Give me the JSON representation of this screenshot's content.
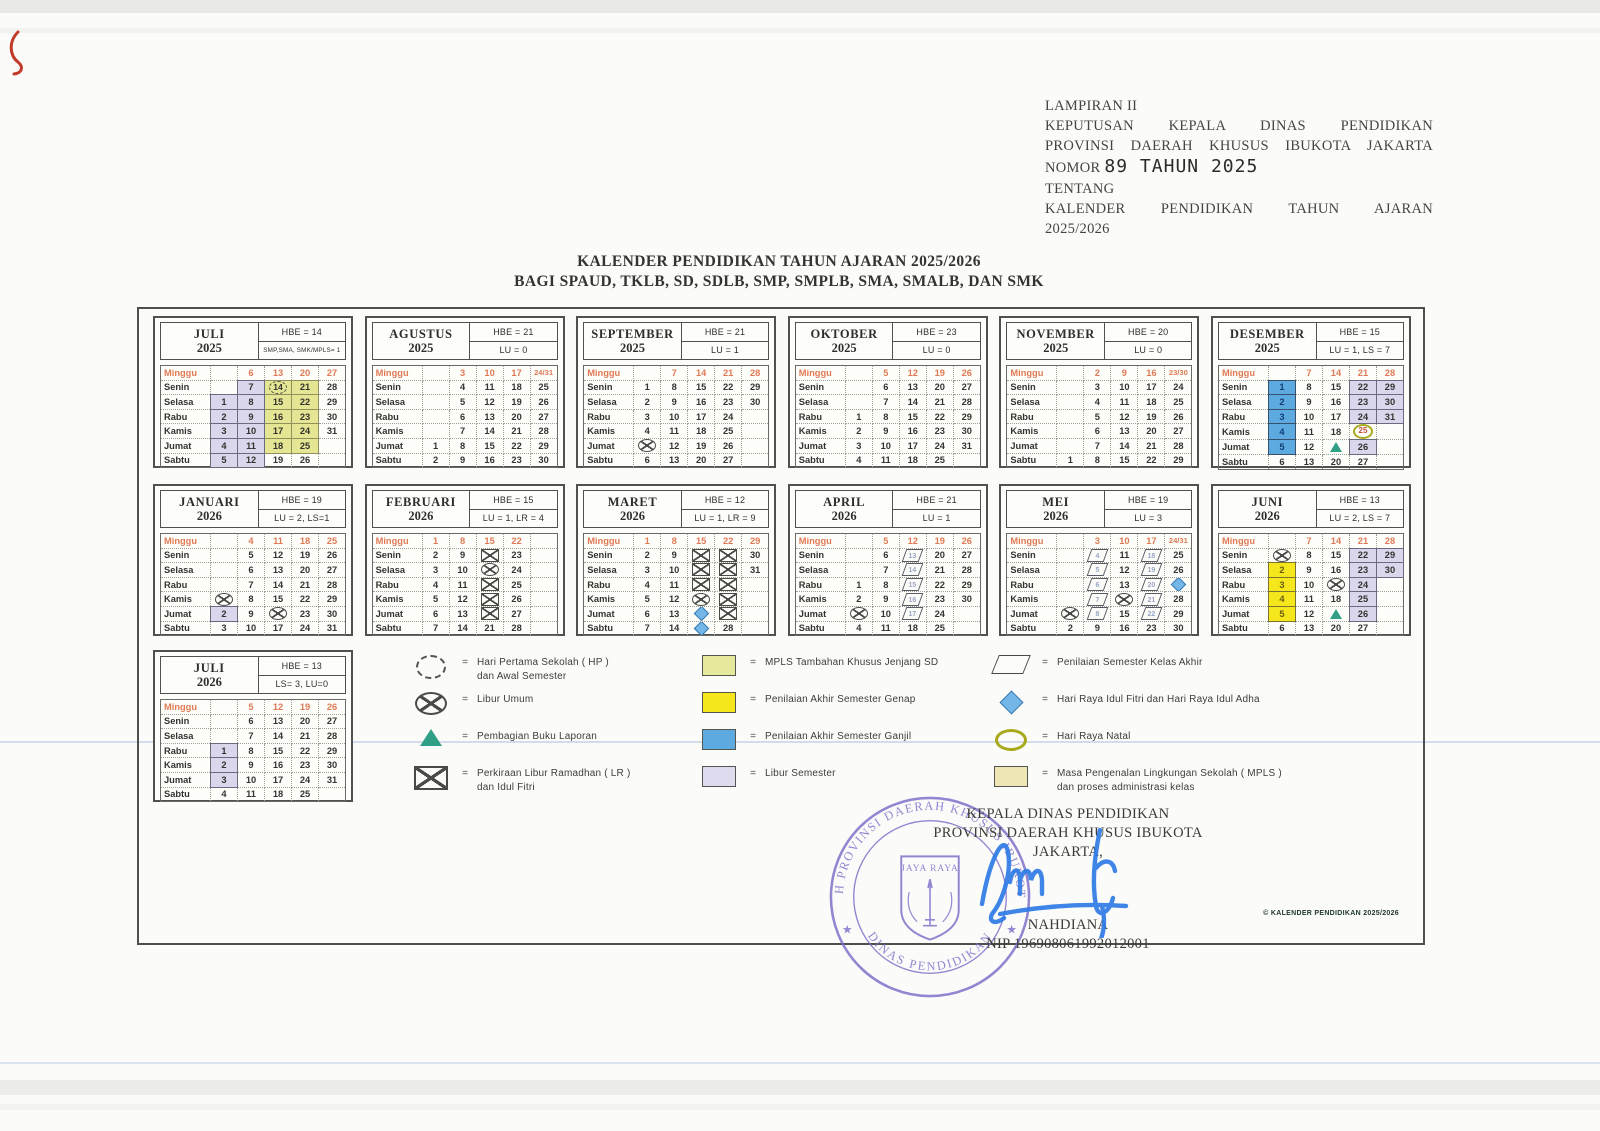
{
  "page": {
    "lampiran": "LAMPIRAN II",
    "keputusan_line1": "KEPUTUSAN KEPALA DINAS PENDIDIKAN",
    "keputusan_line2": "PROVINSI DAERAH KHUSUS IBUKOTA JAKARTA",
    "nomor_label": "NOMOR",
    "nomor_value": "89 TAHUN 2025",
    "tentang": "TENTANG",
    "tentang_line1": "KALENDER PENDIDIKAN TAHUN AJARAN",
    "tentang_line2": "2025/2026",
    "title1": "KALENDER PENDIDIKAN TAHUN AJARAN 2025/2026",
    "title2": "BAGI SPAUD, TKLB, SD, SDLB, SMP, SMPLB, SMA, SMALB, DAN SMK",
    "footnote": "© KALENDER PENDIDIKAN 2025/2026"
  },
  "day_labels": [
    "Minggu",
    "Senin",
    "Selasa",
    "Rabu",
    "Kamis",
    "Jumat",
    "Sabtu"
  ],
  "months": [
    {
      "name": "JULI",
      "year": "2025",
      "stat1": "HBE = 14",
      "stat2": "SMP,SMA, SMK/MPLS= 1",
      "stat2_small": true,
      "row": 1,
      "rows": [
        [
          "",
          "6",
          "13",
          "20",
          "27"
        ],
        [
          "",
          {
            "d": "7",
            "bg": "lav"
          },
          {
            "d": "14",
            "bg": "khaki",
            "m": "hp"
          },
          {
            "d": "21",
            "bg": "khaki"
          },
          "28"
        ],
        [
          {
            "d": "1",
            "bg": "lav"
          },
          {
            "d": "8",
            "bg": "lav"
          },
          {
            "d": "15",
            "bg": "khaki"
          },
          {
            "d": "22",
            "bg": "khaki"
          },
          "29"
        ],
        [
          {
            "d": "2",
            "bg": "lav"
          },
          {
            "d": "9",
            "bg": "lav"
          },
          {
            "d": "16",
            "bg": "khaki"
          },
          {
            "d": "23",
            "bg": "khaki"
          },
          "30"
        ],
        [
          {
            "d": "3",
            "bg": "lav"
          },
          {
            "d": "10",
            "bg": "lav"
          },
          {
            "d": "17",
            "bg": "khaki"
          },
          {
            "d": "24",
            "bg": "khaki"
          },
          "31"
        ],
        [
          {
            "d": "4",
            "bg": "lav"
          },
          {
            "d": "11",
            "bg": "lav"
          },
          {
            "d": "18",
            "bg": "khaki"
          },
          {
            "d": "25",
            "bg": "khaki"
          },
          ""
        ],
        [
          {
            "d": "5",
            "bg": "lav"
          },
          {
            "d": "12",
            "bg": "lav"
          },
          "19",
          "26",
          ""
        ]
      ]
    },
    {
      "name": "AGUSTUS",
      "year": "2025",
      "stat1": "HBE = 21",
      "stat2": "LU = 0",
      "row": 1,
      "rows": [
        [
          "",
          "3",
          "10",
          "17",
          "24/31"
        ],
        [
          "",
          "4",
          "11",
          "18",
          "25"
        ],
        [
          "",
          "5",
          "12",
          "19",
          "26"
        ],
        [
          "",
          "6",
          "13",
          "20",
          "27"
        ],
        [
          "",
          "7",
          "14",
          "21",
          "28"
        ],
        [
          "1",
          "8",
          "15",
          "22",
          "29"
        ],
        [
          "2",
          "9",
          "16",
          "23",
          "30"
        ]
      ]
    },
    {
      "name": "SEPTEMBER",
      "year": "2025",
      "stat1": "HBE = 21",
      "stat2": "LU = 1",
      "row": 1,
      "rows": [
        [
          "",
          "7",
          "14",
          "21",
          "28"
        ],
        [
          "1",
          "8",
          "15",
          "22",
          "29"
        ],
        [
          "2",
          "9",
          "16",
          "23",
          "30"
        ],
        [
          "3",
          "10",
          "17",
          "24",
          ""
        ],
        [
          "4",
          "11",
          "18",
          "25",
          ""
        ],
        [
          {
            "d": "5",
            "m": "lu"
          },
          "12",
          "19",
          "26",
          ""
        ],
        [
          "6",
          "13",
          "20",
          "27",
          ""
        ]
      ]
    },
    {
      "name": "OKTOBER",
      "year": "2025",
      "stat1": "HBE = 23",
      "stat2": "LU = 0",
      "row": 1,
      "rows": [
        [
          "",
          "5",
          "12",
          "19",
          "26"
        ],
        [
          "",
          "6",
          "13",
          "20",
          "27"
        ],
        [
          "",
          "7",
          "14",
          "21",
          "28"
        ],
        [
          "1",
          "8",
          "15",
          "22",
          "29"
        ],
        [
          "2",
          "9",
          "16",
          "23",
          "30"
        ],
        [
          "3",
          "10",
          "17",
          "24",
          "31"
        ],
        [
          "4",
          "11",
          "18",
          "25",
          ""
        ]
      ]
    },
    {
      "name": "NOVEMBER",
      "year": "2025",
      "stat1": "HBE = 20",
      "stat2": "LU = 0",
      "row": 1,
      "rows": [
        [
          "",
          "2",
          "9",
          "16",
          "23/30"
        ],
        [
          "",
          "3",
          "10",
          "17",
          "24"
        ],
        [
          "",
          "4",
          "11",
          "18",
          "25"
        ],
        [
          "",
          "5",
          "12",
          "19",
          "26"
        ],
        [
          "",
          "6",
          "13",
          "20",
          "27"
        ],
        [
          "",
          "7",
          "14",
          "21",
          "28"
        ],
        [
          "1",
          "8",
          "15",
          "22",
          "29"
        ]
      ]
    },
    {
      "name": "DESEMBER",
      "year": "2025",
      "stat1": "HBE = 15",
      "stat2": "LU = 1, LS = 7",
      "row": 1,
      "rows": [
        [
          "",
          "7",
          "14",
          "21",
          "28"
        ],
        [
          {
            "d": "1",
            "bg": "blue"
          },
          "8",
          "15",
          {
            "d": "22",
            "bg": "lav"
          },
          {
            "d": "29",
            "bg": "lav"
          }
        ],
        [
          {
            "d": "2",
            "bg": "blue"
          },
          "9",
          "16",
          {
            "d": "23",
            "bg": "lav"
          },
          {
            "d": "30",
            "bg": "lav"
          }
        ],
        [
          {
            "d": "3",
            "bg": "blue"
          },
          "10",
          "17",
          {
            "d": "24",
            "bg": "lav"
          },
          {
            "d": "31",
            "bg": "lav"
          }
        ],
        [
          {
            "d": "4",
            "bg": "blue"
          },
          "11",
          "18",
          {
            "d": "25",
            "m": "natal"
          },
          ""
        ],
        [
          {
            "d": "5",
            "bg": "blue"
          },
          "12",
          {
            "d": "19",
            "m": "tri"
          },
          {
            "d": "26",
            "bg": "lav"
          },
          ""
        ],
        [
          "6",
          "13",
          "20",
          "27",
          ""
        ]
      ]
    },
    {
      "name": "JANUARI",
      "year": "2026",
      "stat1": "HBE = 19",
      "stat2": "LU = 2, LS=1",
      "row": 2,
      "rows": [
        [
          "",
          "4",
          "11",
          "18",
          "25"
        ],
        [
          "",
          "5",
          "12",
          "19",
          "26"
        ],
        [
          "",
          "6",
          "13",
          "20",
          "27"
        ],
        [
          "",
          "7",
          "14",
          "21",
          "28"
        ],
        [
          {
            "d": "1",
            "m": "lu"
          },
          "8",
          "15",
          "22",
          "29"
        ],
        [
          {
            "d": "2",
            "bg": "lav"
          },
          "9",
          {
            "d": "16",
            "m": "lu"
          },
          "23",
          "30"
        ],
        [
          "3",
          "10",
          "17",
          "24",
          "31"
        ]
      ]
    },
    {
      "name": "FEBRUARI",
      "year": "2026",
      "stat1": "HBE = 15",
      "stat2": "LU = 1, LR = 4",
      "row": 2,
      "rows": [
        [
          "1",
          "8",
          "15",
          "22",
          ""
        ],
        [
          "2",
          "9",
          {
            "d": "16",
            "m": "lr"
          },
          "23",
          ""
        ],
        [
          "3",
          "10",
          {
            "d": "17",
            "m": "lu"
          },
          "24",
          ""
        ],
        [
          "4",
          "11",
          {
            "d": "18",
            "m": "lr"
          },
          "25",
          ""
        ],
        [
          "5",
          "12",
          {
            "d": "19",
            "m": "lr"
          },
          "26",
          ""
        ],
        [
          "6",
          "13",
          {
            "d": "20",
            "m": "lr"
          },
          "27",
          ""
        ],
        [
          "7",
          "14",
          "21",
          "28",
          ""
        ]
      ]
    },
    {
      "name": "MARET",
      "year": "2026",
      "stat1": "HBE = 12",
      "stat2": "LU = 1, LR = 9",
      "row": 2,
      "rows": [
        [
          "1",
          "8",
          "15",
          "22",
          "29"
        ],
        [
          "2",
          "9",
          {
            "d": "16",
            "m": "lr"
          },
          {
            "d": "23",
            "m": "lr"
          },
          "30"
        ],
        [
          "3",
          "10",
          {
            "d": "17",
            "m": "lr"
          },
          {
            "d": "24",
            "m": "lr"
          },
          "31"
        ],
        [
          "4",
          "11",
          {
            "d": "18",
            "m": "lr"
          },
          {
            "d": "25",
            "m": "lr"
          },
          ""
        ],
        [
          "5",
          "12",
          {
            "d": "19",
            "m": "lu"
          },
          {
            "d": "26",
            "m": "lr"
          },
          ""
        ],
        [
          "6",
          "13",
          {
            "d": "20",
            "m": "dia"
          },
          {
            "d": "27",
            "m": "lr"
          },
          ""
        ],
        [
          "7",
          "14",
          {
            "d": "21",
            "m": "dia"
          },
          "28",
          ""
        ]
      ]
    },
    {
      "name": "APRIL",
      "year": "2026",
      "stat1": "HBE = 21",
      "stat2": "LU = 1",
      "row": 2,
      "rows": [
        [
          "",
          "5",
          "12",
          "19",
          "26"
        ],
        [
          "",
          "6",
          {
            "d": "13",
            "m": "par"
          },
          "20",
          "27"
        ],
        [
          "",
          "7",
          {
            "d": "14",
            "m": "par"
          },
          "21",
          "28"
        ],
        [
          "1",
          "8",
          {
            "d": "15",
            "m": "par"
          },
          "22",
          "29"
        ],
        [
          "2",
          "9",
          {
            "d": "16",
            "m": "par"
          },
          "23",
          "30"
        ],
        [
          {
            "d": "3",
            "m": "lu"
          },
          "10",
          {
            "d": "17",
            "m": "par"
          },
          "24",
          ""
        ],
        [
          "4",
          "11",
          "18",
          "25",
          ""
        ]
      ]
    },
    {
      "name": "MEI",
      "year": "2026",
      "stat1": "HBE = 19",
      "stat2": "LU = 3",
      "row": 2,
      "rows": [
        [
          "",
          "3",
          "10",
          "17",
          "24/31"
        ],
        [
          "",
          {
            "d": "4",
            "m": "par"
          },
          "11",
          {
            "d": "18",
            "m": "par"
          },
          "25"
        ],
        [
          "",
          {
            "d": "5",
            "m": "par"
          },
          "12",
          {
            "d": "19",
            "m": "par"
          },
          "26"
        ],
        [
          "",
          {
            "d": "6",
            "m": "par"
          },
          "13",
          {
            "d": "20",
            "m": "par"
          },
          {
            "d": "27",
            "m": "dia"
          }
        ],
        [
          "",
          {
            "d": "7",
            "m": "par"
          },
          {
            "d": "14",
            "m": "lu"
          },
          {
            "d": "21",
            "m": "par"
          },
          "28"
        ],
        [
          {
            "d": "1",
            "m": "lu"
          },
          {
            "d": "8",
            "m": "par"
          },
          "15",
          {
            "d": "22",
            "m": "par"
          },
          "29"
        ],
        [
          "2",
          "9",
          "16",
          "23",
          "30"
        ]
      ]
    },
    {
      "name": "JUNI",
      "year": "2026",
      "stat1": "HBE = 13",
      "stat2": "LU = 2, LS = 7",
      "row": 2,
      "rows": [
        [
          "",
          "7",
          "14",
          "21",
          "28"
        ],
        [
          {
            "d": "1",
            "m": "lu"
          },
          "8",
          "15",
          {
            "d": "22",
            "bg": "lav"
          },
          {
            "d": "29",
            "bg": "lav"
          }
        ],
        [
          {
            "d": "2",
            "bg": "yel"
          },
          "9",
          "16",
          {
            "d": "23",
            "bg": "lav"
          },
          {
            "d": "30",
            "bg": "lav"
          }
        ],
        [
          {
            "d": "3",
            "bg": "yel"
          },
          "10",
          {
            "d": "17",
            "m": "lu"
          },
          {
            "d": "24",
            "bg": "lav"
          },
          ""
        ],
        [
          {
            "d": "4",
            "bg": "yel"
          },
          "11",
          "18",
          {
            "d": "25",
            "bg": "lav"
          },
          ""
        ],
        [
          {
            "d": "5",
            "bg": "yel"
          },
          "12",
          {
            "d": "19",
            "m": "tri"
          },
          {
            "d": "26",
            "bg": "lav"
          },
          ""
        ],
        [
          "6",
          "13",
          "20",
          "27",
          ""
        ]
      ]
    },
    {
      "name": "JULI",
      "year": "2026",
      "stat1": "HBE = 13",
      "stat2": "LS= 3, LU=0",
      "row": 3,
      "rows": [
        [
          "",
          "5",
          "12",
          "19",
          "26"
        ],
        [
          "",
          "6",
          "13",
          "20",
          "27"
        ],
        [
          "",
          "7",
          "14",
          "21",
          "28"
        ],
        [
          {
            "d": "1",
            "bg": "lav"
          },
          "8",
          "15",
          "22",
          "29"
        ],
        [
          {
            "d": "2",
            "bg": "lav"
          },
          "9",
          "16",
          "23",
          "30"
        ],
        [
          {
            "d": "3",
            "bg": "lav"
          },
          "10",
          "17",
          "24",
          "31"
        ],
        [
          "4",
          "11",
          "18",
          "25",
          ""
        ]
      ]
    }
  ],
  "legend": {
    "eq": "=",
    "columns": [
      [
        {
          "icon": "hp",
          "label": "Hari Pertama Sekolah ( HP )",
          "label2": "dan Awal Semester"
        },
        {
          "icon": "lu",
          "label": "Libur Umum"
        },
        {
          "icon": "tri",
          "label": "Pembagian Buku Laporan"
        },
        {
          "icon": "lr",
          "label": "Perkiraan Libur Ramadhan ( LR )",
          "label2": "dan Idul Fitri"
        }
      ],
      [
        {
          "icon": "swatch",
          "color": "#e6e89c",
          "label": "MPLS Tambahan Khusus Jenjang SD"
        },
        {
          "icon": "swatch",
          "color": "#f6e71c",
          "label": "Penilaian Akhir Semester Genap"
        },
        {
          "icon": "swatch",
          "color": "#5caadf",
          "label": "Penilaian Akhir Semester Ganjil"
        },
        {
          "icon": "swatch",
          "color": "#dedbef",
          "label": "Libur Semester"
        }
      ],
      [
        {
          "icon": "par",
          "label": "Penilaian Semester Kelas Akhir"
        },
        {
          "icon": "dia",
          "label": "Hari Raya Idul Fitri dan Hari Raya Idul Adha"
        },
        {
          "icon": "natal",
          "label": "Hari Raya Natal"
        },
        {
          "icon": "swatch",
          "color": "#eee6b4",
          "label": "Masa Pengenalan Lingkungan Sekolah ( MPLS )",
          "label2": "dan proses administrasi kelas"
        }
      ]
    ]
  },
  "signature": {
    "line1": "KEPALA DINAS PENDIDIKAN",
    "line2": "PROVINSI DAERAH KHUSUS IBUKOTA JAKARTA,",
    "name": "NAHDIANA",
    "nip": "NIP 196908061992012001",
    "stamp_arc_top": "PEMERINTAH PROVINSI DAERAH KHUSUS IBUKOTA JAKARTA",
    "stamp_arc_bottom": "DINAS PENDIDIKAN",
    "stamp_center": "JAYA RAYA",
    "stamp_star": "★"
  },
  "colors": {
    "libur_semester": "#dad6ec",
    "pas_ganjil_blue": "#5caadf",
    "pas_genap_yellow": "#f6e71c",
    "mpls_sd_khaki": "#e4e693",
    "mpls_beige": "#eee6b4",
    "minggu_red": "#e07a54",
    "stamp_purple": "#7e6cc9",
    "signature_blue": "#2e7ce6",
    "triangle_teal": "#2fa086"
  }
}
